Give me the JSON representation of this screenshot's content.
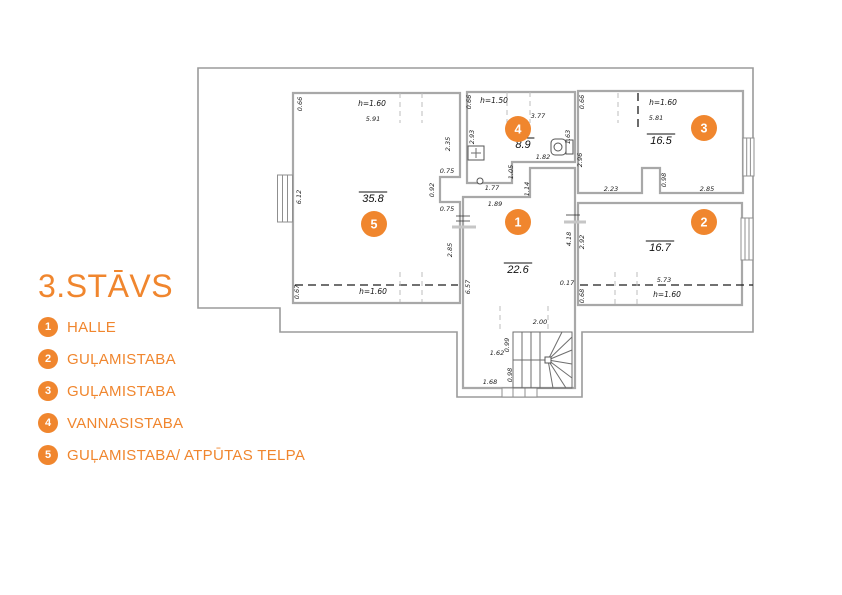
{
  "title": "3.STĀVS",
  "colors": {
    "accent": "#F0862E",
    "wall": "#A8A8A8",
    "dim_text": "#222222"
  },
  "legend": {
    "items": [
      {
        "num": "1",
        "label": "HALLE"
      },
      {
        "num": "2",
        "label": "GUĻAMISTABA"
      },
      {
        "num": "3",
        "label": "GUĻAMISTABA"
      },
      {
        "num": "4",
        "label": "VANNASISTABA"
      },
      {
        "num": "5",
        "label": "GUĻAMISTABA/ ATPŪTAS TELPA"
      }
    ]
  },
  "floorplan": {
    "rooms": [
      {
        "num": "1",
        "area": "22.6",
        "marker": {
          "x": 518,
          "y": 222
        },
        "area_pos": {
          "x": 518,
          "y": 273
        }
      },
      {
        "num": "2",
        "area": "16.7",
        "marker": {
          "x": 704,
          "y": 222
        },
        "area_pos": {
          "x": 660,
          "y": 251
        }
      },
      {
        "num": "3",
        "area": "16.5",
        "marker": {
          "x": 704,
          "y": 128
        },
        "area_pos": {
          "x": 661,
          "y": 144
        }
      },
      {
        "num": "4",
        "area": "8.9",
        "marker": {
          "x": 518,
          "y": 129
        },
        "area_pos": {
          "x": 523,
          "y": 148
        }
      },
      {
        "num": "5",
        "area": "35.8",
        "marker": {
          "x": 374,
          "y": 224
        },
        "area_pos": {
          "x": 373,
          "y": 202
        }
      }
    ],
    "dimensions": [
      {
        "t": "0.66",
        "x": 302,
        "y": 104,
        "r": 1
      },
      {
        "t": "h=1.60",
        "x": 372,
        "y": 106,
        "c": "h"
      },
      {
        "t": "5.91",
        "x": 373,
        "y": 121
      },
      {
        "t": "2.35",
        "x": 450,
        "y": 144,
        "r": 1
      },
      {
        "t": "6.12",
        "x": 301,
        "y": 197,
        "r": 1
      },
      {
        "t": "0.75",
        "x": 447,
        "y": 173
      },
      {
        "t": "0.92",
        "x": 434,
        "y": 190,
        "r": 1
      },
      {
        "t": "0.75",
        "x": 447,
        "y": 211
      },
      {
        "t": "2.85",
        "x": 452,
        "y": 250,
        "r": 1
      },
      {
        "t": "0.67",
        "x": 299,
        "y": 292,
        "r": 1
      },
      {
        "t": "h=1.60",
        "x": 373,
        "y": 294,
        "c": "h"
      },
      {
        "t": "0.66",
        "x": 471,
        "y": 102,
        "r": 1
      },
      {
        "t": "h=1.50",
        "x": 494,
        "y": 103,
        "c": "h"
      },
      {
        "t": "3.77",
        "x": 538,
        "y": 118
      },
      {
        "t": "2.93",
        "x": 474,
        "y": 137,
        "r": 1
      },
      {
        "t": "1.63",
        "x": 570,
        "y": 137,
        "r": 1
      },
      {
        "t": "1.82",
        "x": 543,
        "y": 159
      },
      {
        "t": "1.05",
        "x": 513,
        "y": 172,
        "r": 1
      },
      {
        "t": "1.77",
        "x": 492,
        "y": 190
      },
      {
        "t": "1.14",
        "x": 529,
        "y": 189,
        "r": 1
      },
      {
        "t": "1.89",
        "x": 495,
        "y": 206
      },
      {
        "t": "0.66",
        "x": 584,
        "y": 102,
        "r": 1
      },
      {
        "t": "h=1.60",
        "x": 663,
        "y": 105,
        "c": "h"
      },
      {
        "t": "5.81",
        "x": 656,
        "y": 120
      },
      {
        "t": "2.96",
        "x": 582,
        "y": 160,
        "r": 1
      },
      {
        "t": "0.98",
        "x": 666,
        "y": 180,
        "r": 1
      },
      {
        "t": "2.23",
        "x": 611,
        "y": 191
      },
      {
        "t": "2.85",
        "x": 707,
        "y": 191
      },
      {
        "t": "2.92",
        "x": 584,
        "y": 242,
        "r": 1
      },
      {
        "t": "5.73",
        "x": 664,
        "y": 282
      },
      {
        "t": "h=1.60",
        "x": 667,
        "y": 297,
        "c": "h"
      },
      {
        "t": "0.68",
        "x": 584,
        "y": 296,
        "r": 1
      },
      {
        "t": "4.18",
        "x": 571,
        "y": 239,
        "r": 1
      },
      {
        "t": "0.17",
        "x": 567,
        "y": 285
      },
      {
        "t": "6.57",
        "x": 470,
        "y": 287,
        "r": 1
      },
      {
        "t": "2.00",
        "x": 540,
        "y": 324
      },
      {
        "t": "0.99",
        "x": 509,
        "y": 345,
        "r": 1
      },
      {
        "t": "1.62",
        "x": 497,
        "y": 355
      },
      {
        "t": "0.98",
        "x": 512,
        "y": 375,
        "r": 1
      },
      {
        "t": "1.68",
        "x": 490,
        "y": 384
      }
    ]
  }
}
